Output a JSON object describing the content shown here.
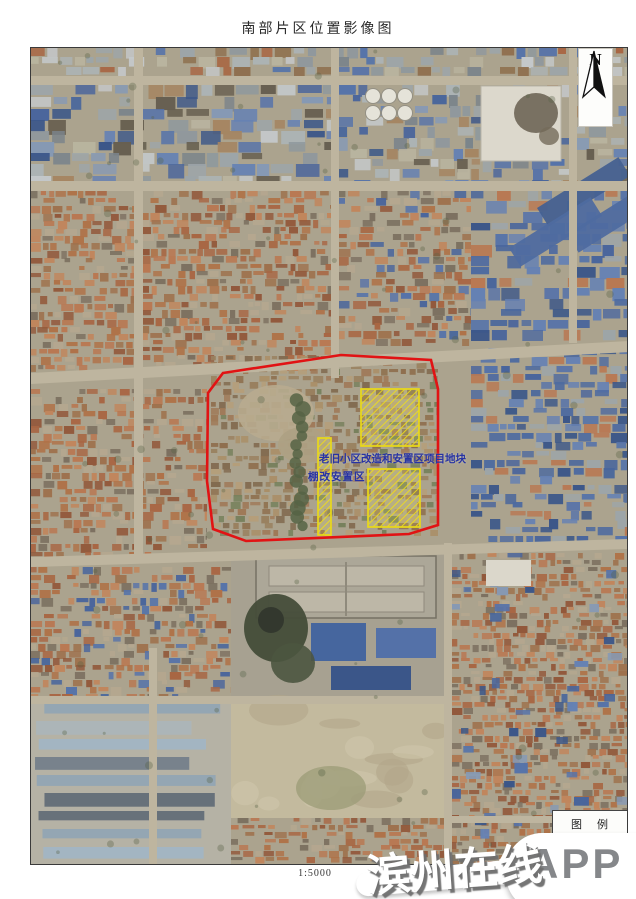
{
  "page_title": "南部片区位置影像图",
  "map": {
    "labels": {
      "line1": "老旧小区改造和安置区项目地块",
      "line2": "棚改安置区"
    }
  },
  "north": {
    "label": "N"
  },
  "legend": {
    "title": "图　例"
  },
  "scale": {
    "label": "1:5000"
  },
  "watermark": {
    "site": "滨州在线",
    "badge": "APP"
  },
  "colors": {
    "boundary": "#e11314",
    "hatch": "#f2e015",
    "label_text": "#2733a3",
    "legend_swatch": "#b5232d"
  }
}
